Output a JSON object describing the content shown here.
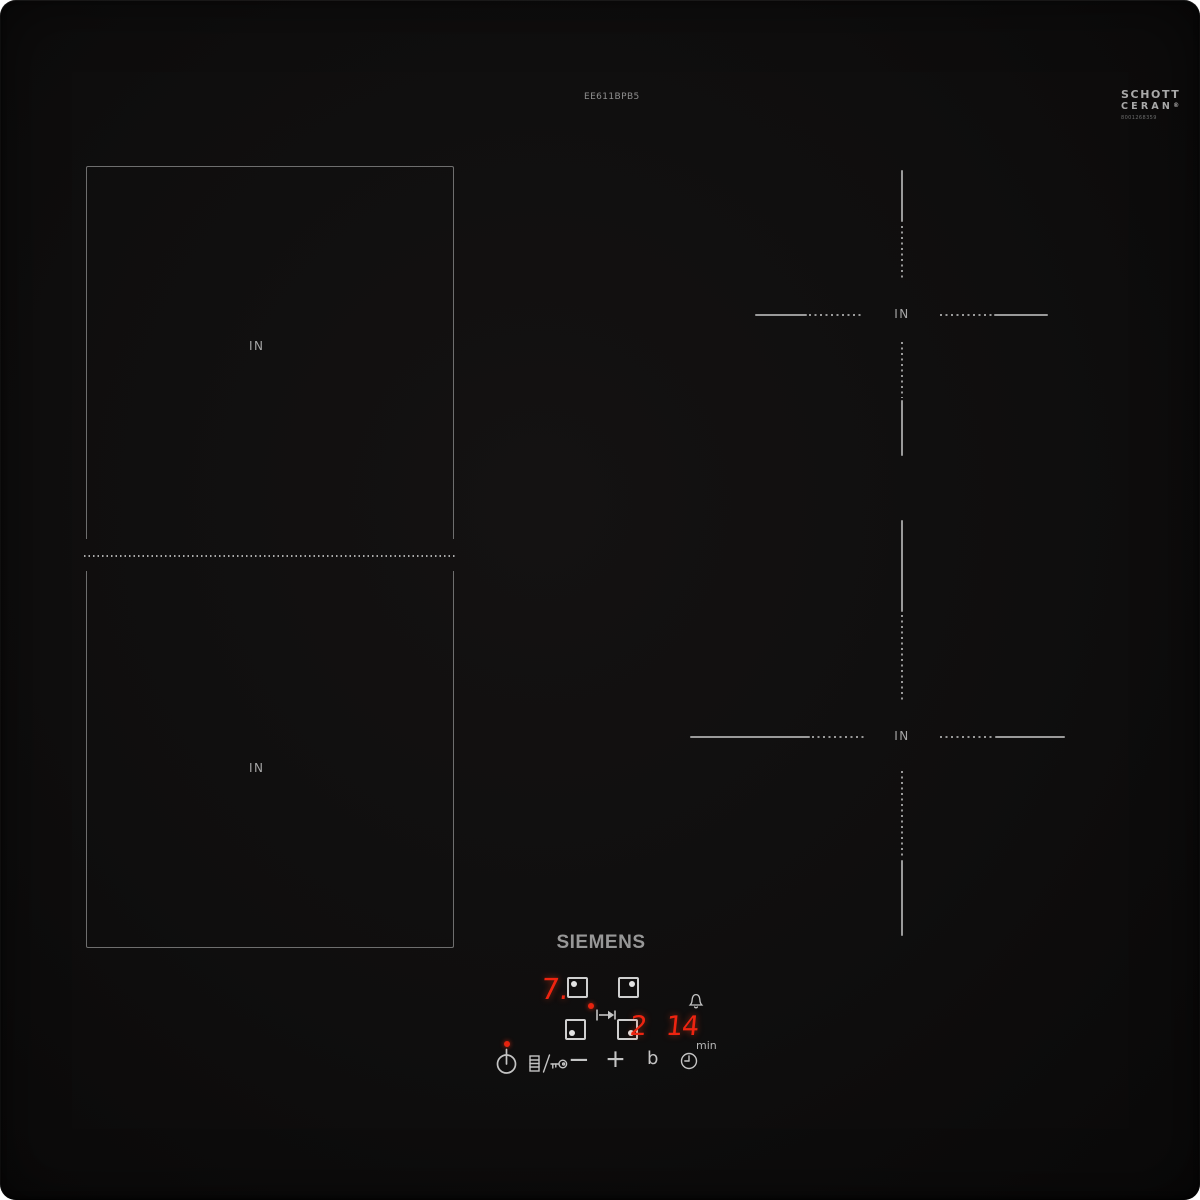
{
  "branding": {
    "model_number": "EE611BPB5",
    "logo": "SIEMENS",
    "glass_logo": {
      "line1": "SCHOTT",
      "line2": "CERAN",
      "registered": "®",
      "code": "8001268359"
    }
  },
  "zones": {
    "left_back": {
      "label": "IN"
    },
    "left_front": {
      "label": "IN"
    },
    "right_back": {
      "label": "IN"
    },
    "right_front": {
      "label": "IN"
    }
  },
  "display": {
    "power_level": "7.",
    "timer_digits": [
      "2",
      "1",
      "4"
    ],
    "timer_unit": "min"
  },
  "controls": {
    "minus_label": "−",
    "plus_label": "+",
    "boost_label": "b"
  },
  "colors": {
    "surface": "#0f0e0e",
    "led_red": "#ee2410",
    "icon_gray": "#c4c4c4",
    "line_gray": "#9a9a9a",
    "label_gray": "#a6a6a6",
    "zone_border_gray": "#6e6e6e"
  }
}
